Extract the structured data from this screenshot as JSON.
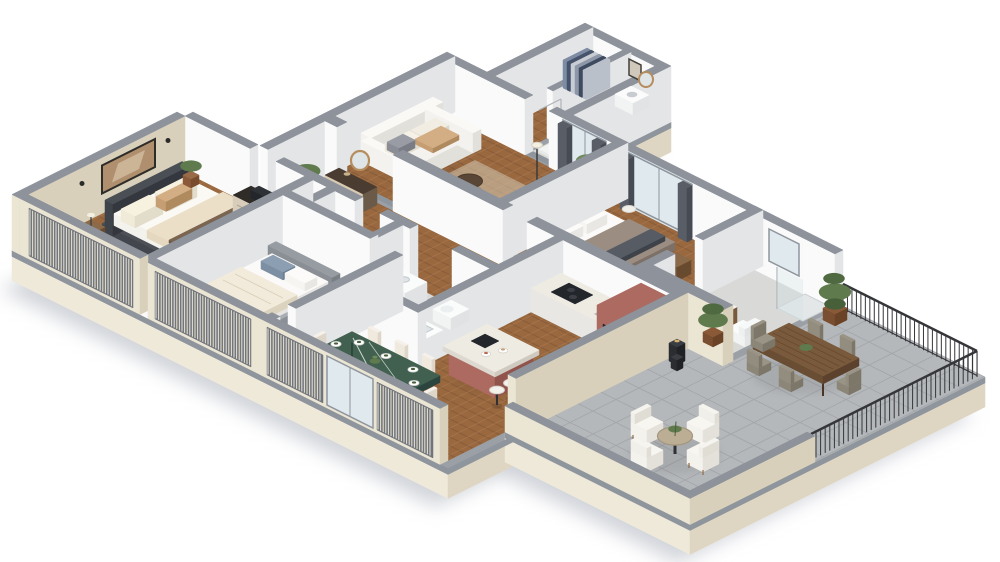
{
  "meta": {
    "description": "Photorealistic 3D isometric floor-plan rendering of a furnished apartment with a wrap-around terrace on white background",
    "image_type": "3d-floorplan-render",
    "background": "#ffffff"
  },
  "palette": {
    "wall_cap": "#8d929b",
    "wall_white_l": "#fafafa",
    "wall_white_d": "#e4e5e7",
    "wall_cream_l": "#ebe5d4",
    "wall_cream_d": "#d8d0ba",
    "slab_l": "#efe9d9",
    "slab_d": "#ded6c2",
    "slab_top": "#9aa0a6",
    "floor_edge": "#8f959c",
    "shadow": "#c7cbd1",
    "wood_floor": "#99683f",
    "wood_dark": "#7b5230",
    "wood_light": "#b5835a",
    "tile_light": "#d9dad8",
    "terrace_tile": "#b5b8bb",
    "terrace_line": "#a2a5a9",
    "glass": "#dfe9ee",
    "frame": "#8f969e",
    "curtain": "#585d66",
    "curtain_d": "#474b53",
    "maroon": "#ad6a60",
    "maroon_d": "#91544c",
    "marble": "#eeebe3",
    "marble_green": "#41604f",
    "marble_green_d": "#2e463c",
    "rug": "#d5cab6",
    "rug2": "#e2ded4",
    "sofa": "#f3f2ee",
    "sofa_d": "#e2e0da",
    "beige": "#e4d9c0",
    "tan": "#c59e74",
    "taupe": "#8d7f74",
    "green": "#5f7a4d",
    "green_d": "#47603a",
    "dark": "#23262b",
    "white": "#ffffff",
    "steel": "#9fa8a6",
    "wood_furn": "#7a5a3c",
    "slat": "#e7e1cf",
    "mirror": "#dfe4e6",
    "railing": "#34363a"
  },
  "rooms": [
    {
      "id": "entry-hall",
      "floor": "wood-herringbone"
    },
    {
      "id": "walk-in-closet",
      "floor": "wood-herringbone"
    },
    {
      "id": "guest-wc",
      "floor": "tile"
    },
    {
      "id": "living-room",
      "floor": "wood-herringbone"
    },
    {
      "id": "bedroom-2",
      "floor": "wood-herringbone"
    },
    {
      "id": "ensuite-bathroom",
      "floor": "tile"
    },
    {
      "id": "laundry-closet",
      "floor": "tile"
    },
    {
      "id": "main-bathroom",
      "floor": "tile"
    },
    {
      "id": "kitchen",
      "floor": "wood-herringbone"
    },
    {
      "id": "dining-area",
      "floor": "wood-herringbone"
    },
    {
      "id": "master-bedroom",
      "floor": "wood-herringbone"
    },
    {
      "id": "bedroom-3",
      "floor": "wood-herringbone"
    },
    {
      "id": "terrace",
      "floor": "stone-tile"
    }
  ],
  "furniture": [
    "corner-sofa",
    "fluffy-armchair",
    "coffee-tables",
    "tv-console",
    "tv",
    "floor-lamp",
    "potted-plants",
    "double-bed-master",
    "double-bed-2",
    "single-bed",
    "dressers",
    "hall-console",
    "round-mirrors",
    "washing-machine",
    "bathtub",
    "vanities",
    "toilet",
    "shower",
    "wall-art",
    "kitchen-counter",
    "cooktop",
    "tall-oven-cabinet",
    "kitchen-island",
    "bar-stools",
    "green-marble-dining-table",
    "dining-chairs",
    "place-settings",
    "terrace-wood-table",
    "terrace-chairs",
    "round-terrace-table",
    "terrace-armchairs",
    "lanterns",
    "railing"
  ]
}
